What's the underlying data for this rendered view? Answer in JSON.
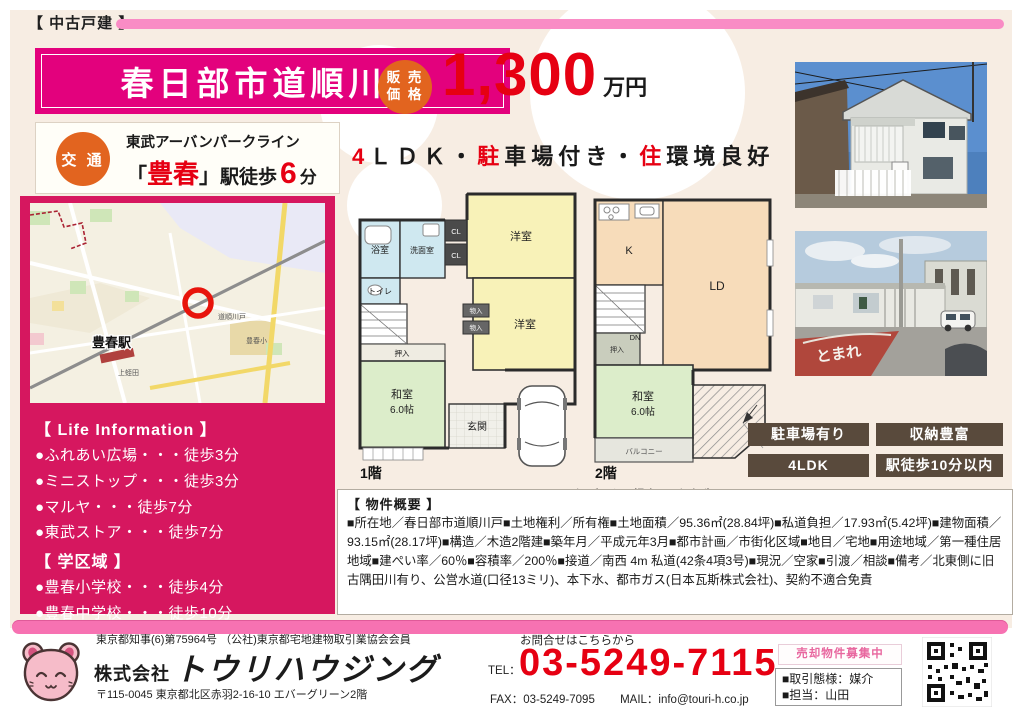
{
  "page": {
    "type_label": "【 中古戸建 】"
  },
  "title": {
    "name": "春日部市道順川戸"
  },
  "transport": {
    "badge": "交 通",
    "line_name": "東武アーバンパークライン",
    "bracket_open": "「",
    "station": "豊春",
    "bracket_close": "」",
    "walk_label": "駅徒歩",
    "minutes": "6",
    "minutes_unit": "分"
  },
  "price": {
    "badge_line1": "販 売",
    "badge_line2": "価 格",
    "value": "1,300",
    "unit": "万円"
  },
  "headline": {
    "red1": "4",
    "part1": "ＬＤＫ・",
    "red2": "駐",
    "part2": "車場付き・",
    "red3": "住",
    "part3": "環境良好"
  },
  "map": {
    "station_label": "豊春駅",
    "area1": "道順川戸",
    "area2": "上蛭田",
    "area3": "豊春小"
  },
  "life_info": {
    "heading": "【 Life Information 】",
    "items": [
      "●ふれあい広場・・・徒歩3分",
      "●ミニストップ・・・徒歩3分",
      "●マルヤ・・・徒歩7分",
      "●東武ストア・・・徒歩7分"
    ],
    "school_heading": "【 学区域 】",
    "school_items": [
      "●豊春小学校・・・徒歩4分",
      "●豊春中学校・・・徒歩10分"
    ]
  },
  "floorplan": {
    "floor1_label": "1階",
    "floor2_label": "2階",
    "bath": "浴室",
    "washroom": "洗面室",
    "toilet": "トイレ",
    "closet": "CL",
    "west_room": "洋室",
    "storage": "物入",
    "oshiire": "押入",
    "japanese_room": "和室",
    "japanese_room_size": "6.0帖",
    "entrance": "玄関",
    "kitchen": "K",
    "living_dining": "LD",
    "down": "DN",
    "balcony": "バルコニー",
    "caption": "図面と現況が異なる場合は現況優先といたします"
  },
  "features": {
    "tags": [
      "駐車場有り",
      "収納豊富",
      "4LDK",
      "駅徒歩10分以内"
    ]
  },
  "overview": {
    "heading": "【 物件概要 】",
    "body": "■所在地／春日部市道順川戸■土地権利／所有権■土地面積／95.36㎡(28.84坪)■私道負担／17.93㎡(5.42坪)■建物面積／93.15㎡(28.17坪)■構造／木造2階建■築年月／平成元年3月■都市計画／市街化区域■地目／宅地■用途地域／第一種住居地域■建ぺい率／60％■容積率／200％■接道／南西 4m 私道(42条4項3号)■現況／空家■引渡／相談■備考／北東側に旧古隅田川有り、公営水道(口径13ミリ)、本下水、都市ガス(日本瓦斯株式会社)、契約不適合免責"
  },
  "footer": {
    "license": "東京都知事(6)第75964号 （公社)東京都宅地建物取引業協会会員",
    "company_prefix": "株式会社",
    "company_name": "トウリハウジング",
    "address": "〒115-0045  東京都北区赤羽2-16-10 エバーグリーン2階",
    "contact_label": "お問合せはこちらから",
    "tel_label": "TEL：",
    "tel": "03-5249-7115",
    "fax": "FAX：03-5249-7095",
    "mail": "MAIL：info@touri-h.co.jp",
    "recruiting": "売却物件募集中",
    "trade_type": "■取引態様：媒介",
    "agent": "■担当：山田"
  },
  "colors": {
    "deep_pink": "#e3017d",
    "panel_pink": "#d6175f",
    "light_pink": "#f98cc5",
    "orange": "#e2641f",
    "red": "#e60012",
    "cream": "#f7ede3",
    "brown": "#594a3c"
  }
}
